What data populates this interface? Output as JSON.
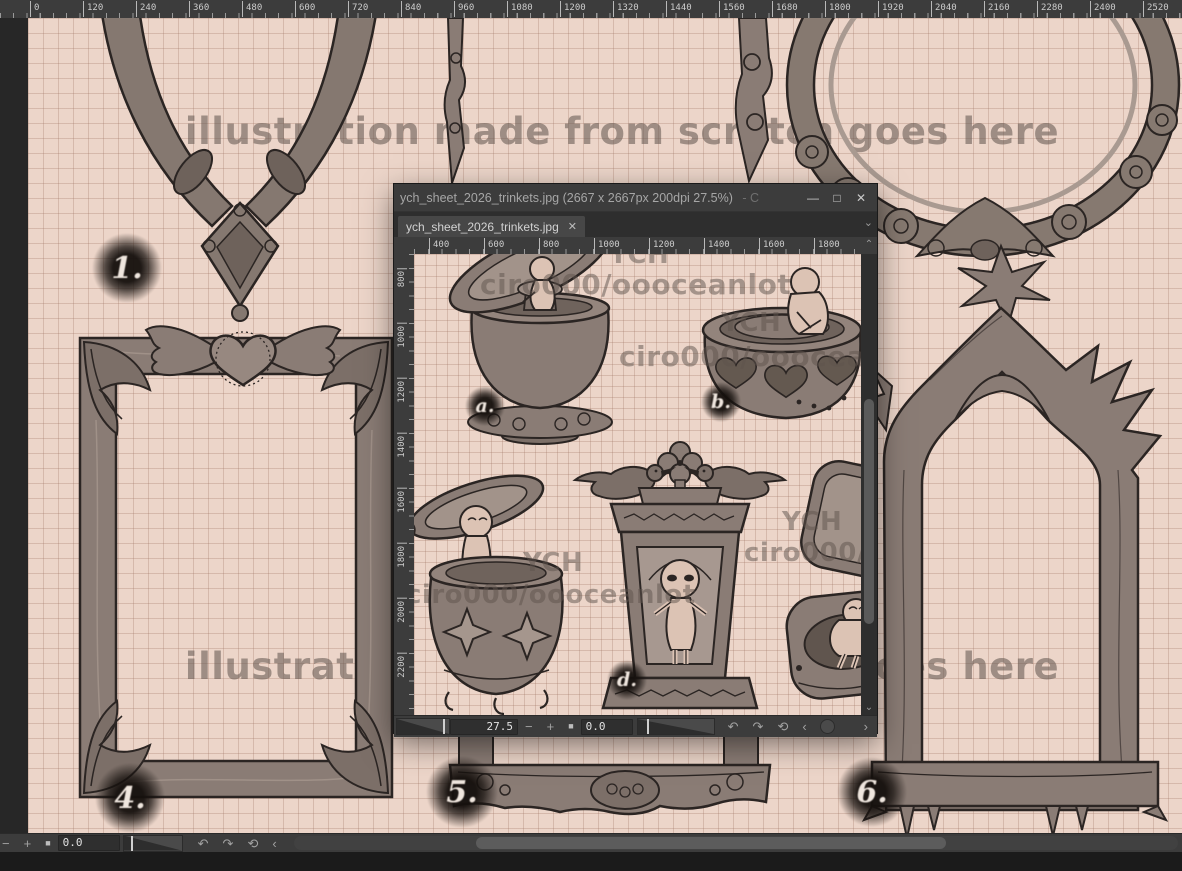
{
  "main_window": {
    "top_ruler_labels": [
      "0",
      "120",
      "240",
      "360",
      "480",
      "600",
      "720",
      "840",
      "960",
      "1080",
      "1200",
      "1320",
      "1440",
      "1560",
      "1680",
      "1800",
      "1920",
      "2040",
      "2160",
      "2280",
      "2400",
      "2520"
    ],
    "status_bar": {
      "zoom_out": "−",
      "zoom_in": "+",
      "stop": "■",
      "rotation_value": "0.0",
      "undo_icon": "↶",
      "redo_icon": "↷",
      "reset_icon": "⟲",
      "collapse_icon": "‹"
    }
  },
  "floating_window": {
    "title": "ych_sheet_2026_trinkets.jpg (2667 x 2667px 200dpi 27.5%)",
    "title_trail": "- C",
    "minimize_icon": "—",
    "maximize_icon": "□",
    "close_icon": "✕",
    "tab_label": "ych_sheet_2026_trinkets.jpg",
    "tab_close_icon": "✕",
    "tab_menu_icon": "⌄",
    "top_ruler_labels": [
      "400",
      "600",
      "800",
      "1000",
      "1200",
      "1400",
      "1600",
      "1800"
    ],
    "left_ruler_labels": [
      "800",
      "1000",
      "1200",
      "1400",
      "1600",
      "1800",
      "2000",
      "2200"
    ],
    "scroll_up_icon": "⌃",
    "scroll_down_icon": "⌄",
    "status_bar": {
      "zoom_value": "27.5",
      "zoom_out": "−",
      "zoom_in": "+",
      "stop": "■",
      "rotation_value": "0.0",
      "undo_icon": "↶",
      "redo_icon": "↷",
      "reset_icon": "⟲",
      "prev_icon": "‹",
      "knob_icon": "",
      "next_icon": "›"
    }
  },
  "artwork": {
    "watermark_text": "illustration made from scratch goes here",
    "frame_labels": {
      "one": "1.",
      "four": "4.",
      "five": "5.",
      "six": "6."
    }
  },
  "trinket_sheet": {
    "ych": "YCH",
    "handle": "ciro000/oooceanlot",
    "item_labels": {
      "a": "a.",
      "b": "b.",
      "d": "d."
    }
  },
  "colors": {
    "canvas_bg": "#ecd5c9",
    "grid_line": "#d9bfb2",
    "artwork_ink": "#2b2523",
    "artwork_fill": "#8a7c75",
    "skin": "#dcc3b4",
    "chrome": "#3c3c3c",
    "chrome_dark": "#1d1d1d"
  }
}
